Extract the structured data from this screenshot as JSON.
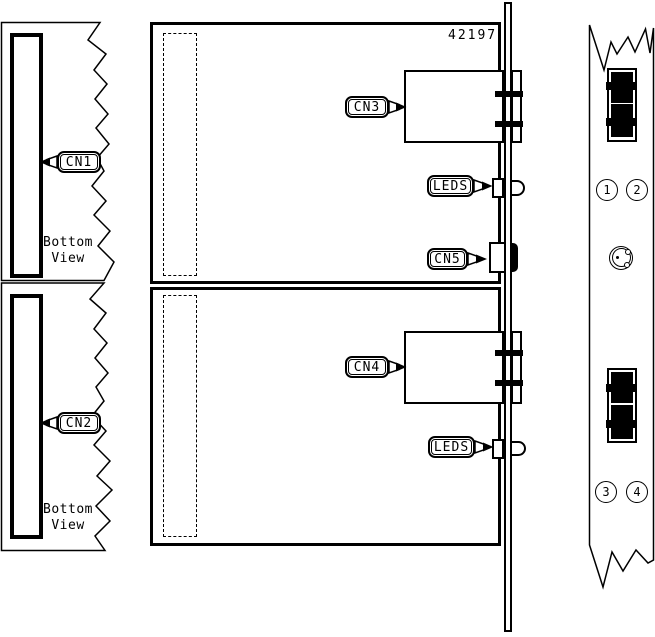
{
  "diagram": {
    "part_number": "42197",
    "callouts": {
      "cn1": "CN1",
      "cn2": "CN2",
      "cn3": "CN3",
      "cn4": "CN4",
      "cn5": "CN5",
      "leds_upper": "LEDS",
      "leds_lower": "LEDS"
    },
    "view_labels": {
      "upper_line1": "Bottom",
      "upper_line2": "View",
      "lower_line1": "Bottom",
      "lower_line2": "View"
    },
    "port_numbers": [
      "1",
      "2",
      "3",
      "4"
    ],
    "colors": {
      "line": "#000000",
      "background": "#ffffff",
      "connector_fill": "#000000"
    }
  }
}
